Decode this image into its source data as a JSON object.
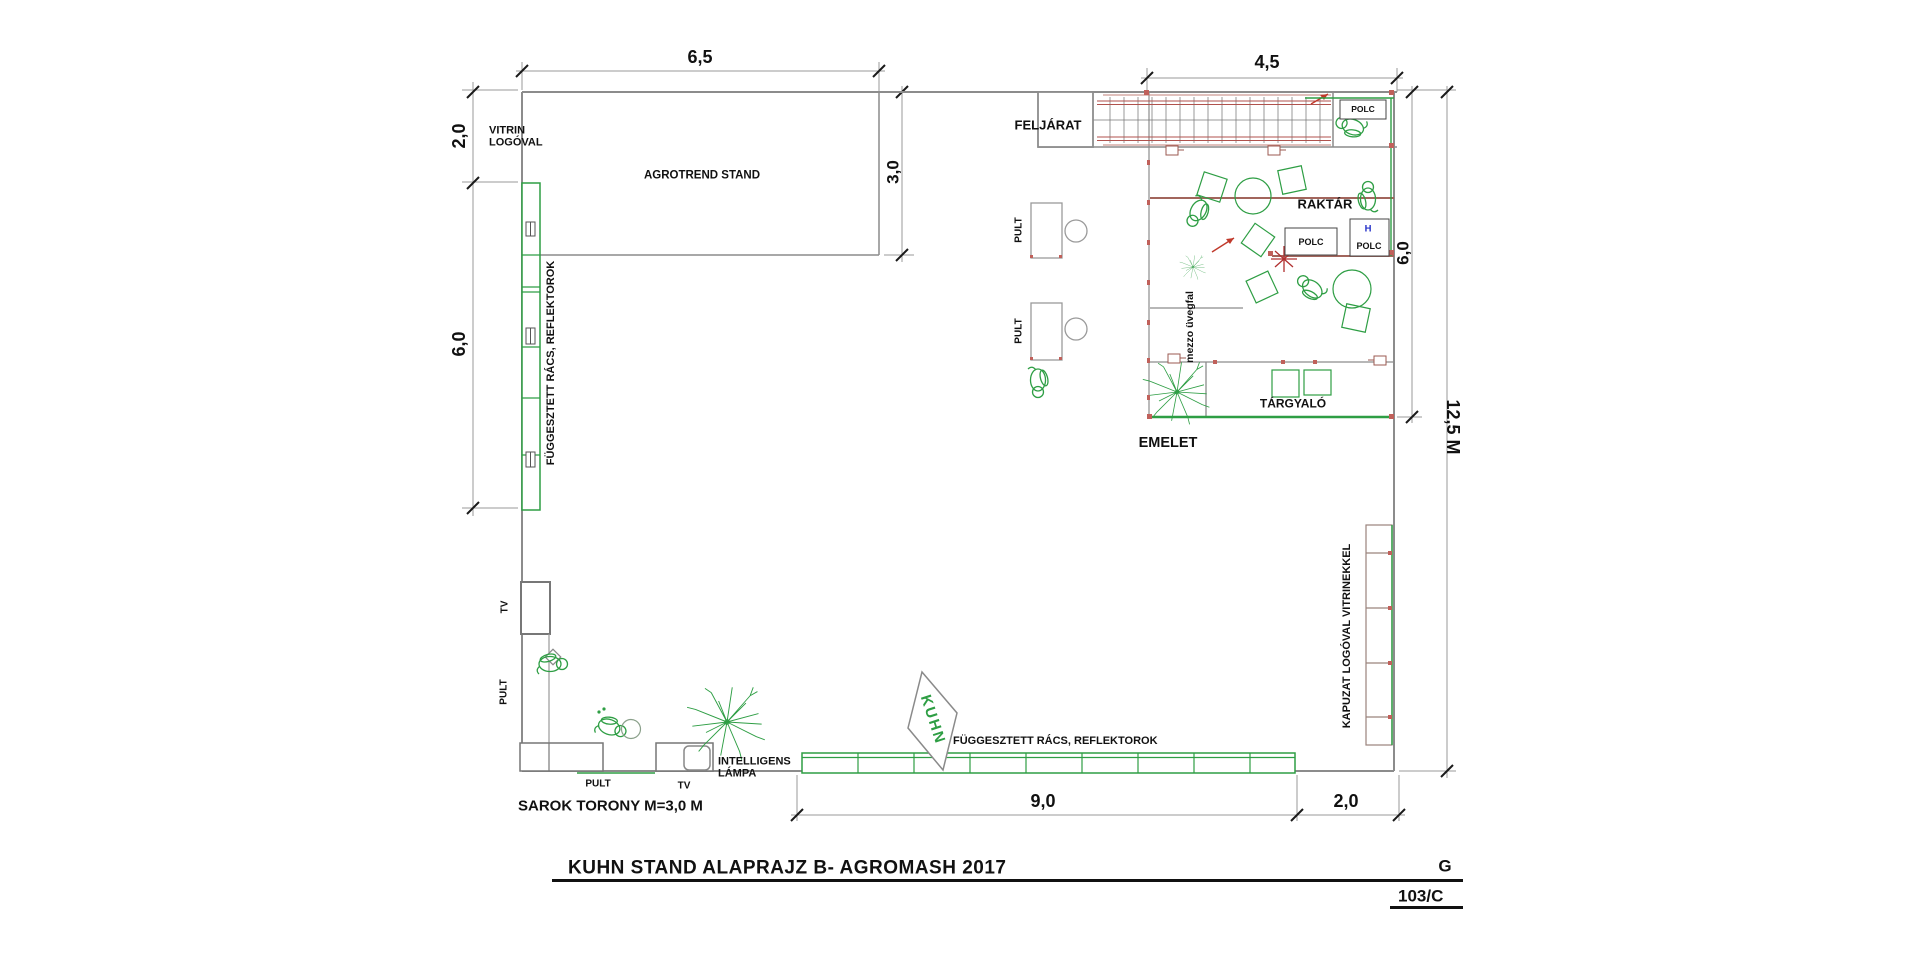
{
  "drawing": {
    "title": "KUHN STAND ALAPRAJZ B-  AGROMASH 2017",
    "sheet_letter": "G",
    "sheet_code": "103/C"
  },
  "dims": {
    "top_width": "6,5",
    "upper_right_width": "4,5",
    "left_upper": "2,0",
    "left_mid": "6,0",
    "agrotrend_depth": "3,0",
    "emelet_depth": "6,0",
    "total_depth": "12,5 M",
    "bottom_width": "9,0",
    "bottom_right_width": "2,0"
  },
  "labels": {
    "vitrin_logoval": "VITRIN\nLOGÓVAL",
    "agrotrend_stand": "AGROTREND STAND",
    "feljarat": "FELJÁRAT",
    "polc": "POLC",
    "polc_h": "H",
    "raktar": "RAKTÁR",
    "mezzo_uvegfal": "mezzo üvegfal",
    "pult": "PULT",
    "targyalo": "TÁRGYALÓ",
    "emelet": "EMELET",
    "fuggesztett": "FÜGGESZTETT RÁCS, REFLEKTOROK",
    "tv": "TV",
    "intelligens_lampa": "INTELLIGENS\nLÁMPA",
    "sarok_torony": "SAROK TORONY M=3,0 M",
    "kapuzat": "KAPUZAT LOGÓVAL VITRINEKKEL",
    "kuhn": "KUHN"
  },
  "colors": {
    "green": "#2e9e44",
    "wall_gray": "#8c8c8c",
    "red_accent": "#b0524d",
    "blue": "#2430c8",
    "text": "#111111"
  }
}
